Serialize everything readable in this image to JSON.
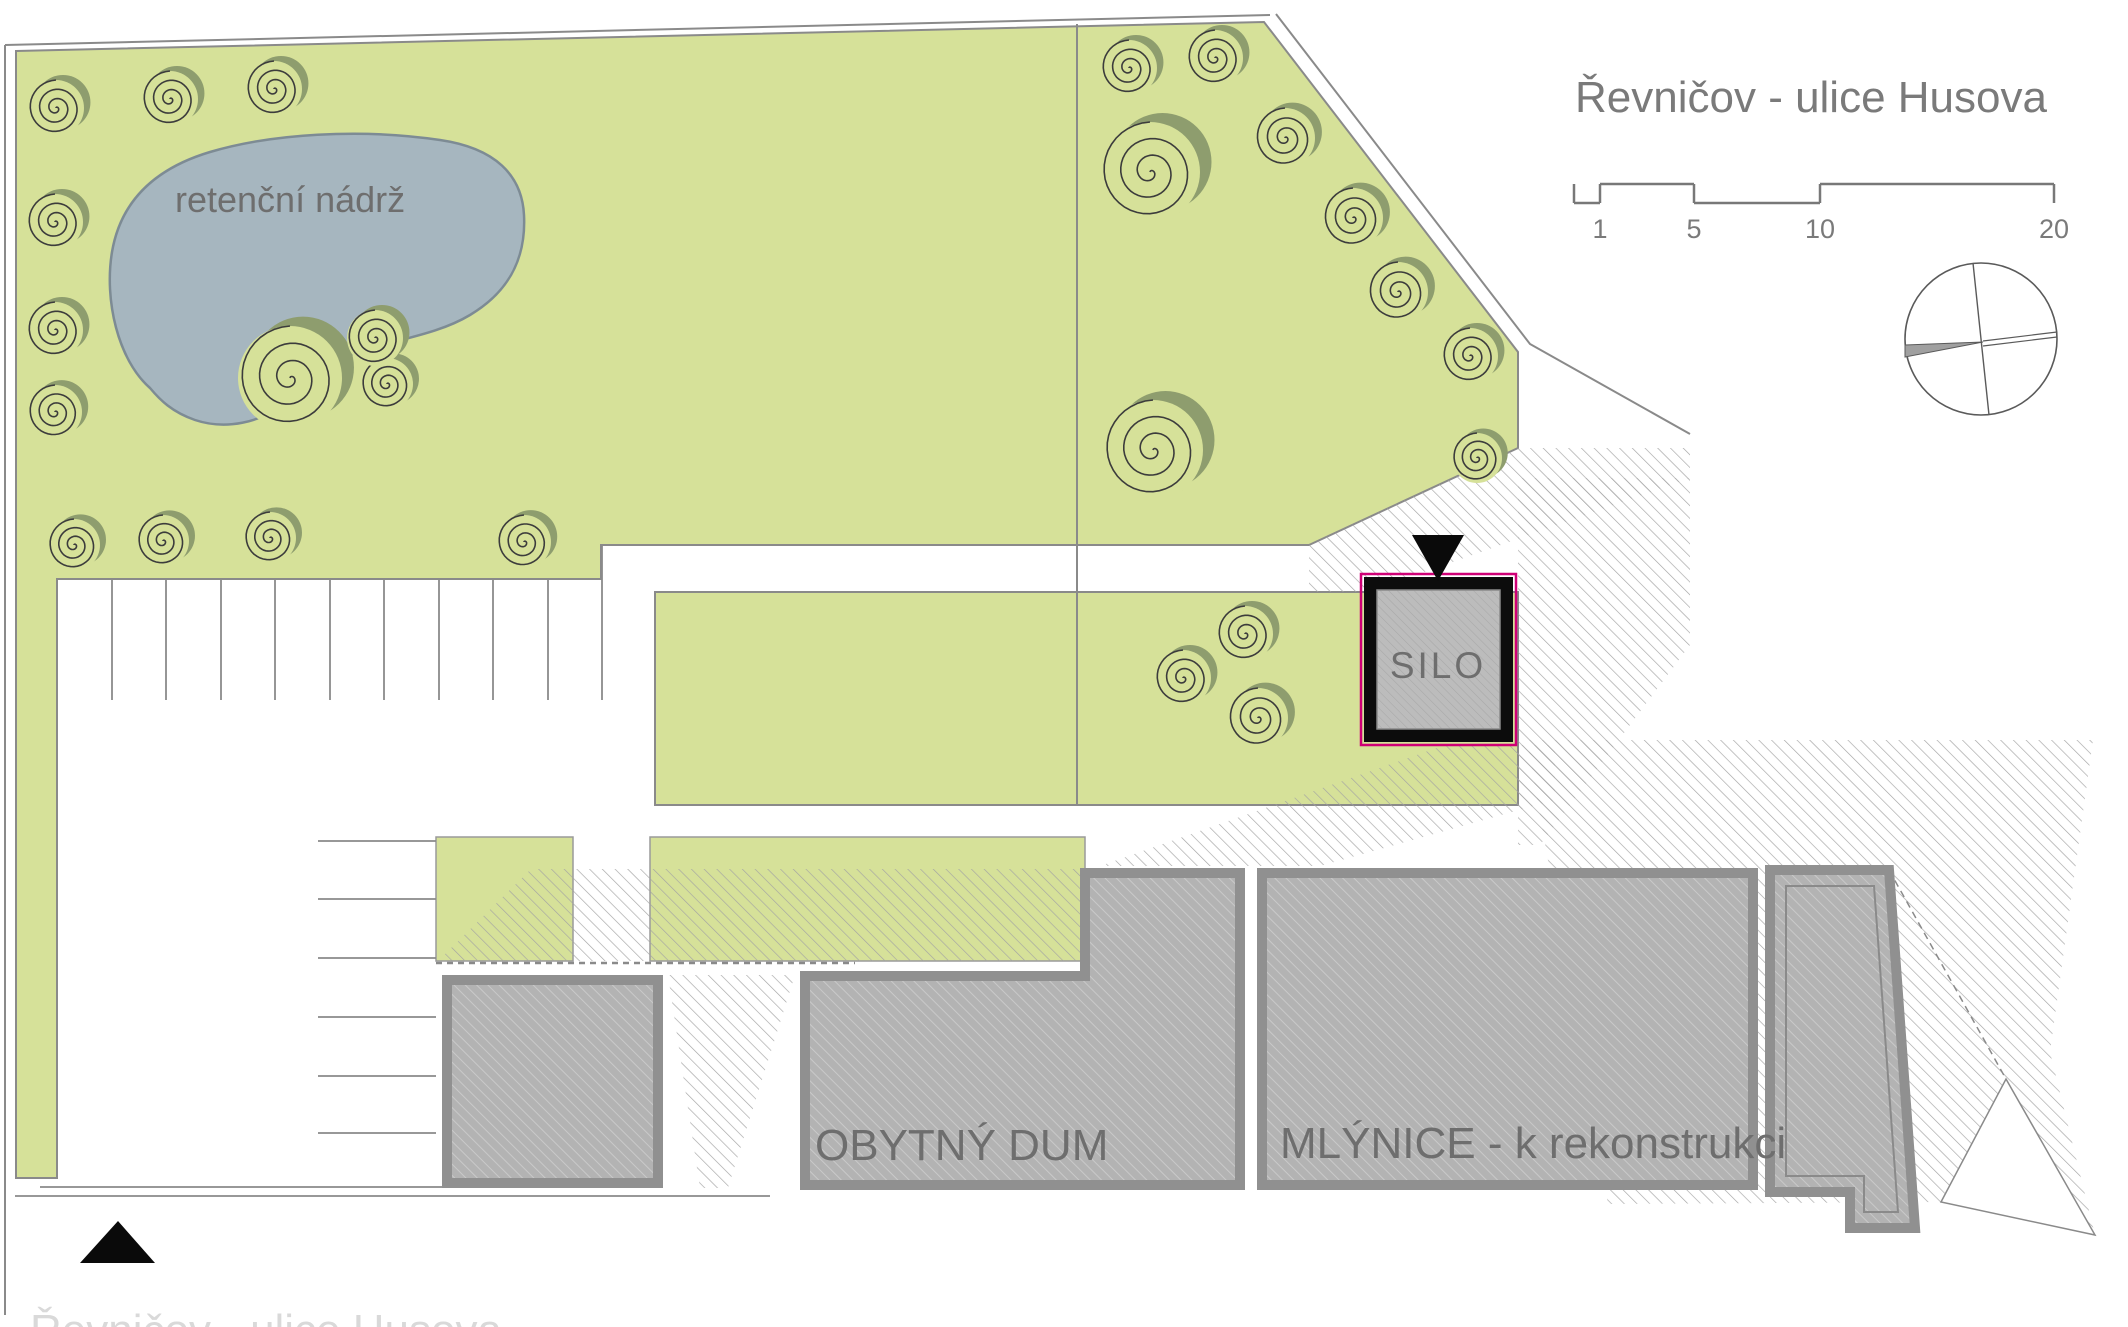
{
  "title": "Řevničov - ulice Husova",
  "footer_text": "Řevničov - ulice Husova",
  "labels": {
    "pond": "retenční nádrž",
    "silo": "SILO",
    "residential_house": "OBYTNÝ DUM",
    "mill": "MLÝNICE - k rekonstrukci"
  },
  "scale_bar": {
    "ticks": [
      "1",
      "5",
      "10",
      "20"
    ]
  },
  "colors": {
    "green": "#d6e199",
    "tree_shadow": "#8e9d6e",
    "tree_stroke": "#3c3c3c",
    "pond_fill": "#a6b6bf",
    "pond_stroke": "#7d8b94",
    "hatch_line": "#a3a3a3",
    "building_fill": "#b3b3b3",
    "building_hatch": "#c9c9c9",
    "building_border": "#909090",
    "silo_border": "#0c0c0c",
    "silo_accent": "#cf0076",
    "line": "#8a8a8a",
    "label_text": "#6e6e6e",
    "title_text": "#7a7a7a",
    "faint_text": "#d9d9d9",
    "marker_black": "#0a0a0a"
  },
  "trees": {
    "top_left": [
      [
        56,
        108,
        28
      ],
      [
        170,
        99,
        28
      ],
      [
        274,
        89,
        28
      ],
      [
        55,
        222,
        28
      ],
      [
        55,
        330,
        28
      ],
      [
        55,
        412,
        27
      ],
      [
        74,
        545,
        26
      ],
      [
        163,
        541,
        26
      ],
      [
        270,
        538,
        26
      ],
      [
        387,
        384,
        26
      ],
      [
        290,
        378,
        52
      ],
      [
        375,
        338,
        28
      ],
      [
        524,
        542,
        27
      ]
    ],
    "top_right": [
      [
        1129,
        68,
        28
      ],
      [
        1215,
        58,
        28
      ],
      [
        1150,
        172,
        50
      ],
      [
        1285,
        138,
        30
      ],
      [
        1353,
        218,
        30
      ],
      [
        1398,
        292,
        30
      ],
      [
        1470,
        356,
        28
      ],
      [
        1153,
        450,
        50
      ],
      [
        1477,
        458,
        25
      ]
    ],
    "courtyard": [
      [
        1245,
        634,
        28
      ],
      [
        1183,
        678,
        28
      ],
      [
        1258,
        718,
        30
      ]
    ]
  }
}
